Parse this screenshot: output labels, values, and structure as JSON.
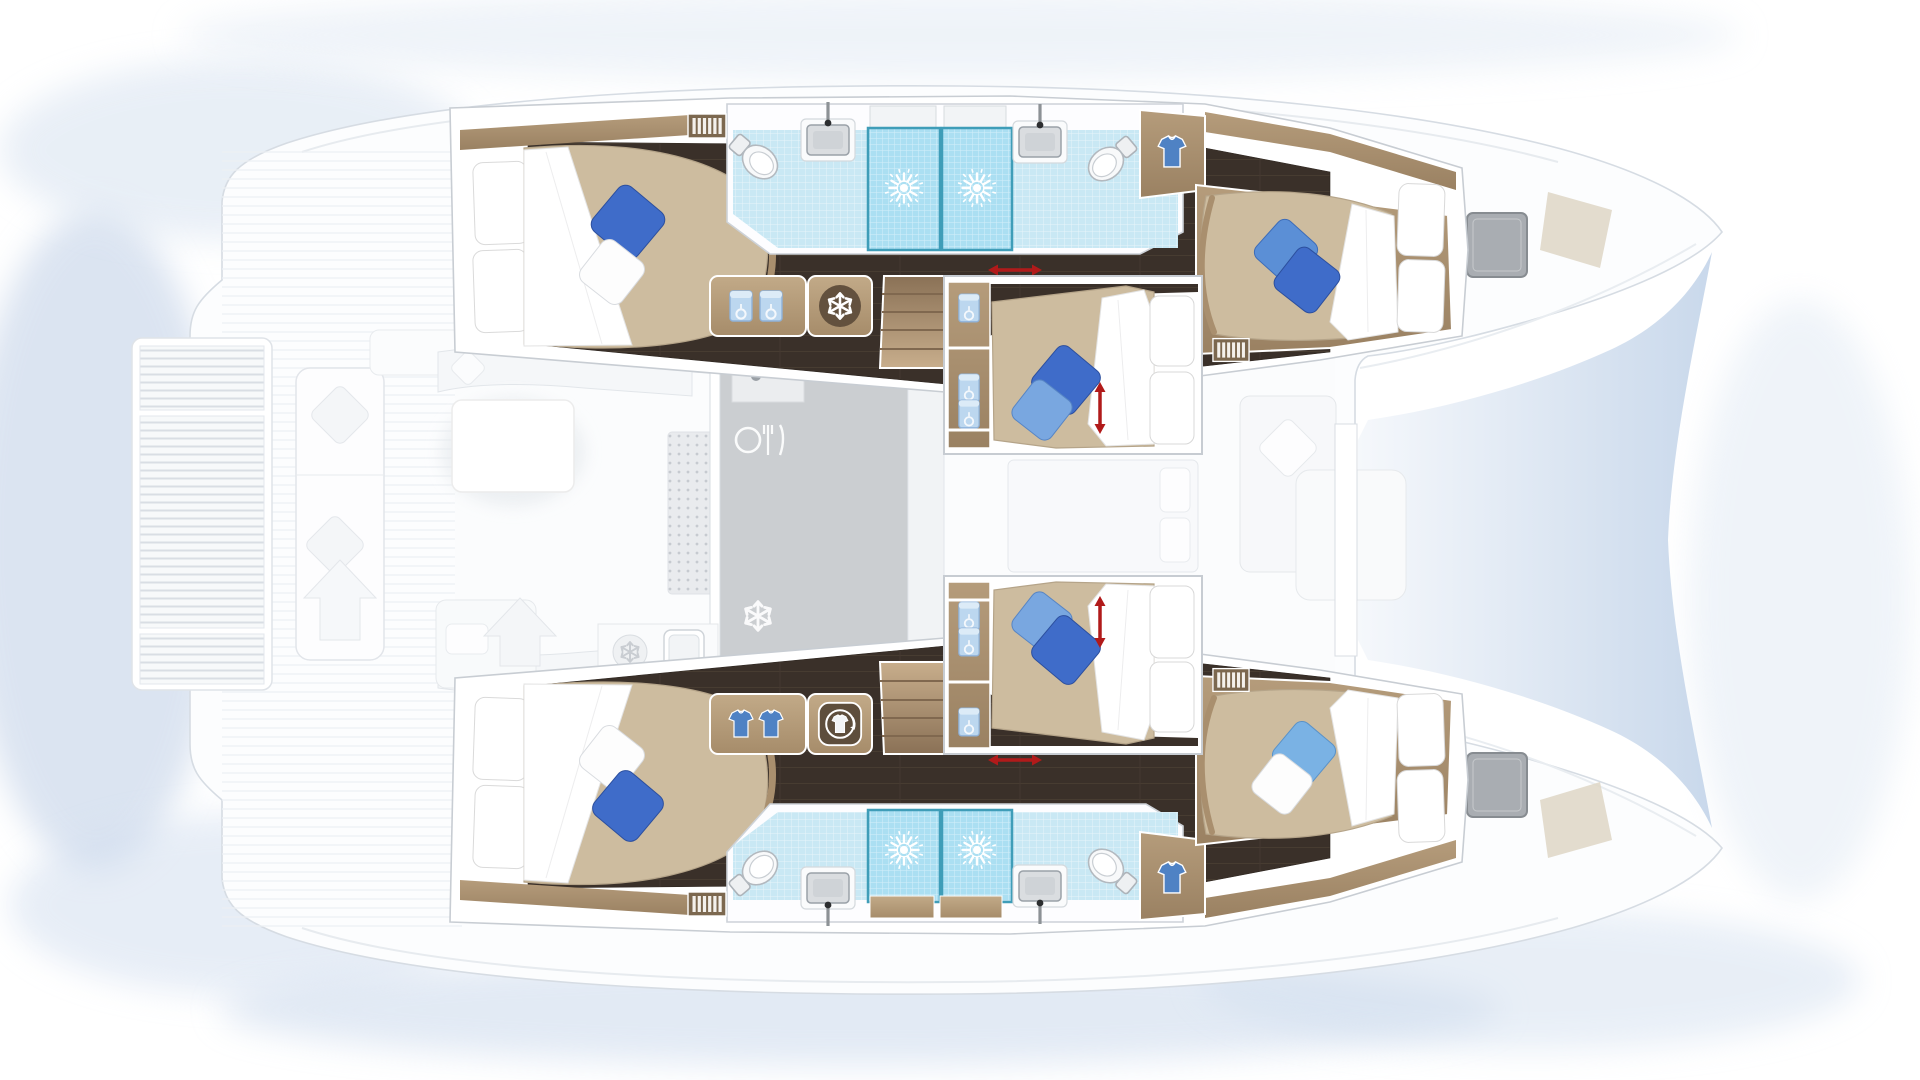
{
  "image": {
    "kind": "catamaran-yacht-floorplan",
    "view": "top-down",
    "orientation": "bows-right",
    "visible_text": []
  },
  "palette": {
    "hull_ghost": "#fcfdfe",
    "outline": "#d6dce3",
    "dark_floor": "#3a3029",
    "wood": "#a98f6e",
    "duvet": "#cdbc9f",
    "tile_light": "#c9e8f4",
    "tile_shower": "#abdff2",
    "shower_frame": "#3f9db8",
    "pillow_royal": "#3f6cc9",
    "pillow_mid": "#5b8fd6",
    "pillow_light_blue": "#79a7e0",
    "pillow_sky": "#7ab2e4",
    "pillow_white": "#ffffff",
    "arrow_red": "#b11a1a",
    "galley_gray": "#cbced1",
    "tramp_from": "#f4f7fb",
    "tramp_to": "#c3d4e9"
  },
  "rooms": {
    "upper_hull": {
      "aft_cabin": {
        "bed": "double",
        "deco_pillows": [
          "royal-blue",
          "white"
        ],
        "head_pillows": 2,
        "features": [
          "louver-vent"
        ]
      },
      "bathroom": {
        "fixtures": [
          "toilet",
          "washbasin",
          "shower",
          "shower",
          "washbasin",
          "toilet"
        ],
        "shower_symbol": "sunburst",
        "wardrobe": "shirt-icon"
      },
      "forward_cabin": {
        "bed": "double",
        "deco_pillows": [
          "mid-blue",
          "royal-blue"
        ],
        "head_pillows": 2,
        "features": [
          "louver-vent"
        ]
      },
      "corridor": {
        "cabinet_icons": [
          "hanging-bag",
          "hanging-bag",
          "fridge-snowflake"
        ],
        "stairs": true,
        "sliding_indicator": "red-horizontal-arrow"
      }
    },
    "lower_hull": {
      "aft_cabin": {
        "bed": "double",
        "deco_pillows": [
          "white",
          "royal-blue"
        ],
        "head_pillows": 2,
        "features": [
          "louver-vent"
        ]
      },
      "bathroom": {
        "fixtures": [
          "toilet",
          "washbasin",
          "shower",
          "shower",
          "washbasin",
          "toilet"
        ],
        "shower_symbol": "sunburst",
        "wardrobe": "shirt-icon"
      },
      "forward_cabin": {
        "bed": "double",
        "deco_pillows": [
          "sky-blue",
          "white"
        ],
        "head_pillows": 2,
        "features": [
          "louver-vent"
        ]
      },
      "corridor": {
        "cabinet_icons": [
          "shirt",
          "shirt",
          "washing-machine"
        ],
        "stairs": true,
        "sliding_indicator": "red-horizontal-arrow"
      }
    },
    "center_cabins": [
      {
        "name": "center-upper",
        "bed": "double",
        "deco_pillows": [
          "royal-blue",
          "light-blue"
        ],
        "head_pillows": 2,
        "storage_pouches": 3,
        "bed_adjust_indicator": "red-vertical-arrow"
      },
      {
        "name": "center-lower",
        "bed": "double",
        "deco_pillows": [
          "light-blue",
          "royal-blue"
        ],
        "head_pillows": 2,
        "storage_pouches": 3,
        "bed_adjust_indicator": "red-vertical-arrow"
      }
    ],
    "salon_ghost": {
      "items": [
        "l-sofa",
        "coffee-table",
        "dotted-rug",
        "chaise",
        "galley-counter",
        "faucet",
        "dining-cutlery-icon",
        "snowflake-icon",
        "snowflake-circle-icon",
        "galley-sink"
      ]
    },
    "deck_ghost": {
      "items": [
        "aft-swim-platform-slats",
        "aft-bench-cushions",
        "fore-cockpit-seats",
        "bow-trampoline",
        "deck-hatch-upper",
        "deck-hatch-lower",
        "sail-locker-upper",
        "sail-locker-lower"
      ]
    }
  }
}
